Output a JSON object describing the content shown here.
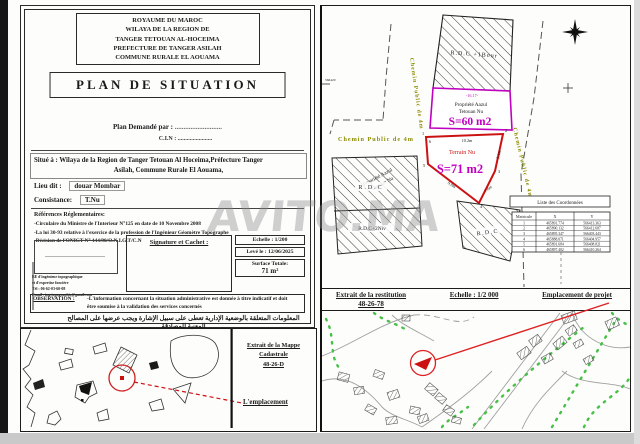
{
  "watermark": "AVITO.MA",
  "colors": {
    "parcel60_border": "#c000c0",
    "parcel71_border": "#cc1111",
    "dimension_text": "#009f9f",
    "road_label": "#8b8b00",
    "vegetation": "#46c046",
    "marker": "#cc1111"
  },
  "form": {
    "header_lines": [
      "ROYAUME DU MAROC",
      "WILAYA DE LA REGION DE",
      "TANGER TETOUAN AL-HOCEIMA",
      "PREFECTURE DE TANGER ASILAH",
      "COMMUNE RURALE EL AOUAMA"
    ],
    "title": "PLAN DE SITUATION",
    "requested_label": "Plan Demandé par :",
    "requested_dots": "...........................",
    "cin_label": "C.I.N :",
    "cin_dots": ".......................",
    "situe_line1": "Situé à : Wilaya de la Region de Tanger Tetouan Al Hoceima,Préfecture Tanger",
    "situe_line2": "Asilah, Commune Rurale El Aouama,",
    "lieu_label": "Lieu dit :",
    "lieu_value": "douar Mombar",
    "consistance_label": "Consistance:",
    "consistance_value": "T.Nu",
    "references_title": "Références Réglementaires:",
    "references": [
      "-Circulaire du Ministre de l'Interieur N°125 en date de 10 Novembre 2008",
      "-La loi 30-93 relative à l'exercice de la profession de l'Ingénieur Géomètre Topographe",
      "-Décision de l'ONIGT N°  444/90/O.N.I.G.T/C.N"
    ],
    "signature_label": "Signature et Cachet :",
    "office_lines": [
      "BE d'ingénieur topographique",
      "et d'expertise foncière",
      "Tél : 06-62-03-60-08",
      "Email : ing.topographie@gmail.com"
    ],
    "echelle": "Echelle : 1/200",
    "leve": "Levé le : 12/06/2025",
    "surface_label": "Surface Totale:",
    "surface_value": "71 m²",
    "observation_label": "OBSERVATION :",
    "observation_line1": "-L'information concernant la situation administrative est donnée à titre indicatif et doit",
    "observation_line2": "être soumise à la validation des services concernés",
    "arabic_note": "المعلومات المتعلقة بالوضعية الإدارية تعطى على سبيل الإشارة ويجب عرضها على المصالح المعنية للمصادقة"
  },
  "site": {
    "grid_label": "566420",
    "road_label": "Chemin Public de 4m",
    "building_top_label": "R.D.C +1Bour",
    "parcel60_owner": "Propriété Aazul",
    "parcel60_type": "Tetouan Nu",
    "parcel60_area": "S=60 m2",
    "parcel60_dim": "-16.17-",
    "parcel71_type": "Terrain Nu",
    "parcel71_area": "S=71 m2",
    "dim1": "10.2m",
    "dim2": "5.4m",
    "dim3": "7.6m",
    "dim4": "9.8m",
    "v1": "1",
    "v2": "2",
    "v3": "3",
    "v4": "4",
    "v5": "5",
    "v6": "6",
    "neighbor_line1": "Propriété Aazul",
    "neighbor_line2": "Tetouan Nu",
    "rdc_a": "R.D.C",
    "rdc_b": "R.D.C+2Niv",
    "rdc_c": "R.D.C",
    "table_title": "Liste des Coordonnées",
    "col_matricule": "Matricule",
    "col_x": "X",
    "col_y": "Y",
    "rows": [
      [
        "1",
        "465891.774",
        "566413.363"
      ],
      [
        "2",
        "465890.132",
        "566412.687"
      ],
      [
        "3",
        "465895.347",
        "566403.443"
      ],
      [
        "4",
        "465888.071",
        "566404.957"
      ],
      [
        "5",
        "465891.684",
        "566408.821"
      ],
      [
        "6",
        "465897.402",
        "566410.264"
      ]
    ]
  },
  "strip": {
    "restitution_line1": "Extrait de la restitution",
    "restitution_line2": "48-26-78",
    "echelle": "Echelle : 1/2 000",
    "emplacement": "Emplacement de projet"
  },
  "cadastre": {
    "title_line1": "Extrait de la Mappe Cadastrale",
    "title_line2": "48-26-D",
    "emplacement": "L'emplacement"
  }
}
